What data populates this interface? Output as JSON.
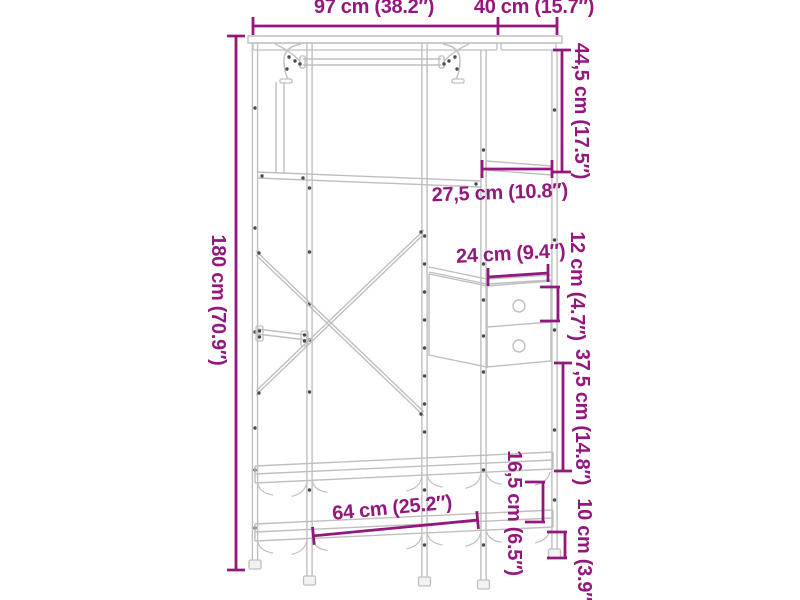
{
  "page": {
    "background": "#ffffff",
    "description": "Line-art product dimension diagram of an open wardrobe clothes rack with hanging rod, side drawers and shelves"
  },
  "colors": {
    "annotation": "#93187E",
    "line_art": "#bfbfbf",
    "screw_dots": "#4b4b4b",
    "background": "#ffffff"
  },
  "dimensions": {
    "total_width": {
      "label": "97 cm (38.2″)"
    },
    "total_depth": {
      "label": "40 cm (15.7″)"
    },
    "total_height": {
      "label": "180 cm (70.9″)"
    },
    "top_section_height": {
      "label": "44,5 cm (17.5″)"
    },
    "side_shelf_depth": {
      "label": "27,5 cm (10.8″)"
    },
    "drawer_width": {
      "label": "24 cm (9.4″)"
    },
    "drawer_height": {
      "label": "12 cm (4.7″)"
    },
    "mid_section_height": {
      "label": "37,5 cm (14.8″)"
    },
    "shelf_gap_height": {
      "label": "16,5 cm (6.5″)"
    },
    "ground_clearance": {
      "label": "10 cm (3.9″)"
    },
    "shelf_length": {
      "label": "64 cm (25.2″)"
    }
  }
}
